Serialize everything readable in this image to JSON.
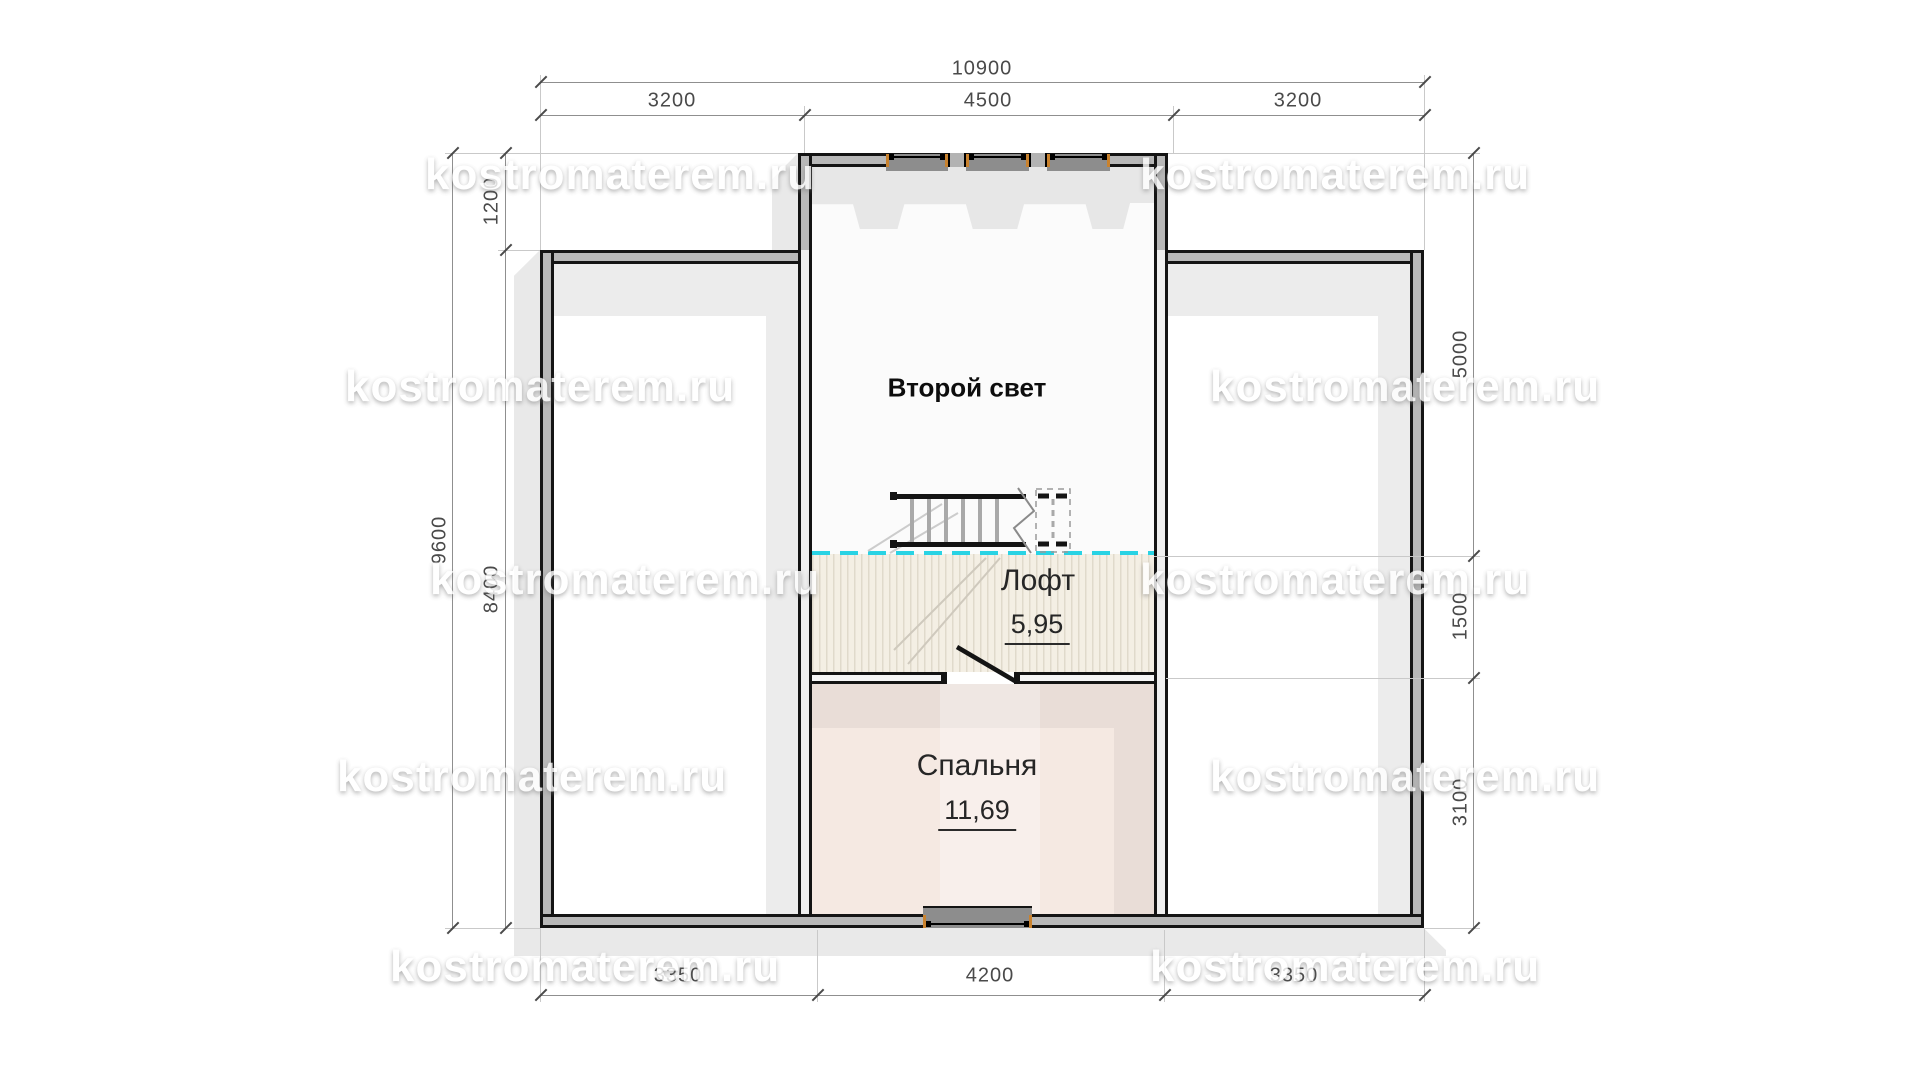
{
  "title": "Mansard floor plan",
  "watermark": {
    "text": "kostromaterem.ru"
  },
  "rooms": {
    "second_light": {
      "label": "Второй свет"
    },
    "loft": {
      "label": "Лофт",
      "area": "5,95"
    },
    "bedroom": {
      "label": "Спальня",
      "area": "11,69"
    }
  },
  "dimensions": {
    "top": {
      "total": "10900",
      "segments": [
        "3200",
        "4500",
        "3200"
      ]
    },
    "left": {
      "total": "9600",
      "upper": "1200",
      "lower": "8400"
    },
    "right": {
      "segments": [
        "5000",
        "1500",
        "3100"
      ]
    },
    "bottom": {
      "segments": [
        "3350",
        "4200",
        "3350"
      ]
    }
  },
  "colors": {
    "wall_fill": "#b8b8b8",
    "outline": "#141414",
    "open_area_band": "#e7e7e7",
    "loft_floor": "#f4efe4",
    "bedroom_floor": "#f5e9e2",
    "bedroom_band": "#e9ddd7",
    "wing_band": "#ececec",
    "cyan_divider": "#29d3e4",
    "window_accent": "#c9822e",
    "shadow": "#e9e9e9",
    "dim_text": "#4a4a4a"
  }
}
